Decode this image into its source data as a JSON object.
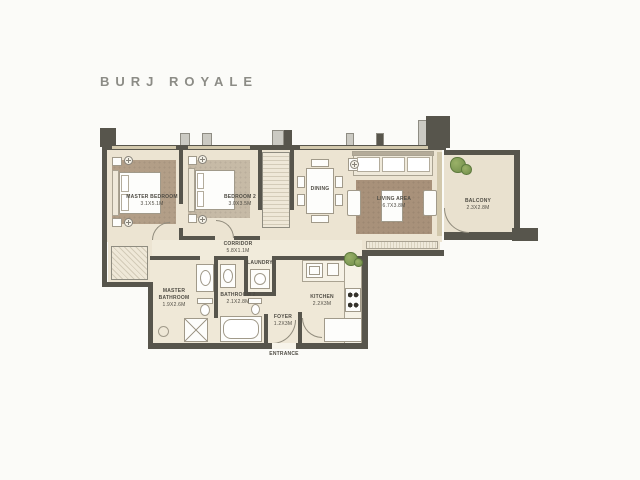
{
  "page": {
    "title": "BURJ ROYALE"
  },
  "colors": {
    "wall": "#57554c",
    "floor": "#ece4d2",
    "floor_light": "#f1ebdb",
    "rug_brown": "#a8917a",
    "plant_green": "#7d9c55",
    "title_text": "#8c8c86",
    "label_text": "#4f4c44"
  },
  "rooms": {
    "master_bedroom": {
      "label": "MASTER BEDROOM",
      "dim": "3.1X5.1M"
    },
    "bedroom_2": {
      "label": "BEDROOM 2",
      "dim": "3.0X3.5M"
    },
    "dining": {
      "label": "DINING"
    },
    "living_area": {
      "label": "LIVING AREA",
      "dim": "6.7X3.8M"
    },
    "balcony": {
      "label": "BALCONY",
      "dim": "2.3X2.8M"
    },
    "corridor": {
      "label": "CORRIDOR",
      "dim": "5.8X1.1M"
    },
    "master_bathroom": {
      "label": "MASTER BATHROOM",
      "dim": "1.9X2.6M"
    },
    "bathroom_2": {
      "label": "BATHROOM 2",
      "dim": "2.1X2.8M"
    },
    "laundry": {
      "label": "LAUNDRY"
    },
    "kitchen": {
      "label": "KITCHEN",
      "dim": "2.2X3M"
    },
    "foyer": {
      "label": "FOYER",
      "dim": "1.2X3M"
    },
    "entrance": {
      "label": "ENTRANCE"
    }
  }
}
